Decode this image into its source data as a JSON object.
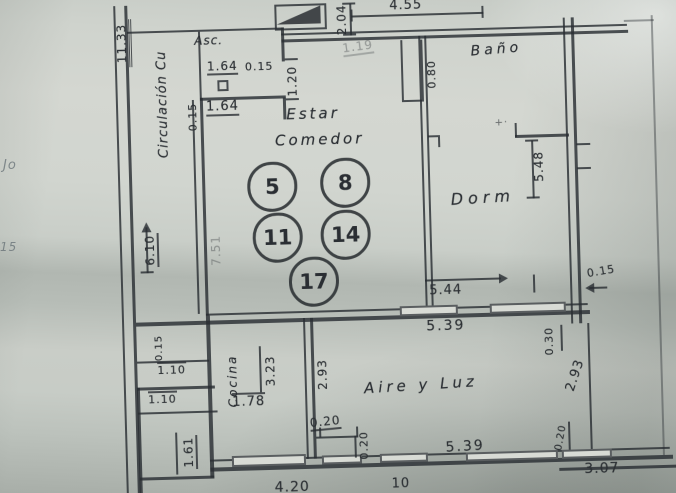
{
  "type": "architectural-floor-plan-photo",
  "rooms": {
    "circulacion": "Circulación Cu",
    "ascensor": "Asc.",
    "estar": "Estar",
    "comedor": "Comedor",
    "bano": "Baño",
    "dormitorio": "Dorm",
    "aire_y_luz": "Aire y Luz",
    "cocina": "Cocina"
  },
  "unit_numbers": [
    "5",
    "8",
    "11",
    "14",
    "17"
  ],
  "dimensions": {
    "left_total": "11.33",
    "asc_width": "1.64",
    "asc_wall": "0.15",
    "stair_width": "2.04",
    "top_width": "4.55",
    "top_faint": "1.19",
    "entry_opening": "1.20",
    "bano_door": "0.80",
    "estar_wall": "0.15",
    "estar_offset": "1.64",
    "dorm_depth": "5.48",
    "right_wall": "0.15",
    "corridor_length": "6.10",
    "estar_depth": "7.51",
    "estar_width": "5.44",
    "aire_width_top": "5.39",
    "mid_wall": "0.30",
    "aire_depth_right": "2.93",
    "corner_wall": "0.15",
    "step_a": "1.10",
    "step_b": "1.10",
    "corner_height": "1.61",
    "cocina_depth": "3.23",
    "cocina_depth2": "2.93",
    "cocina_window": "1.78",
    "patio_step_w": "0.20",
    "patio_step_h": "0.20",
    "bottom_right_wall": "0.20",
    "bottom_width": "5.39",
    "bottom_right_width": "3.07",
    "bottom_left_width": "4.20",
    "bottom_mark": "10"
  },
  "margin_notes": {
    "upper": "Jo",
    "lower": "15"
  },
  "marks": {
    "cross": "+·"
  },
  "colors": {
    "ink": "#34383c",
    "paper": "#cfd3cd"
  }
}
